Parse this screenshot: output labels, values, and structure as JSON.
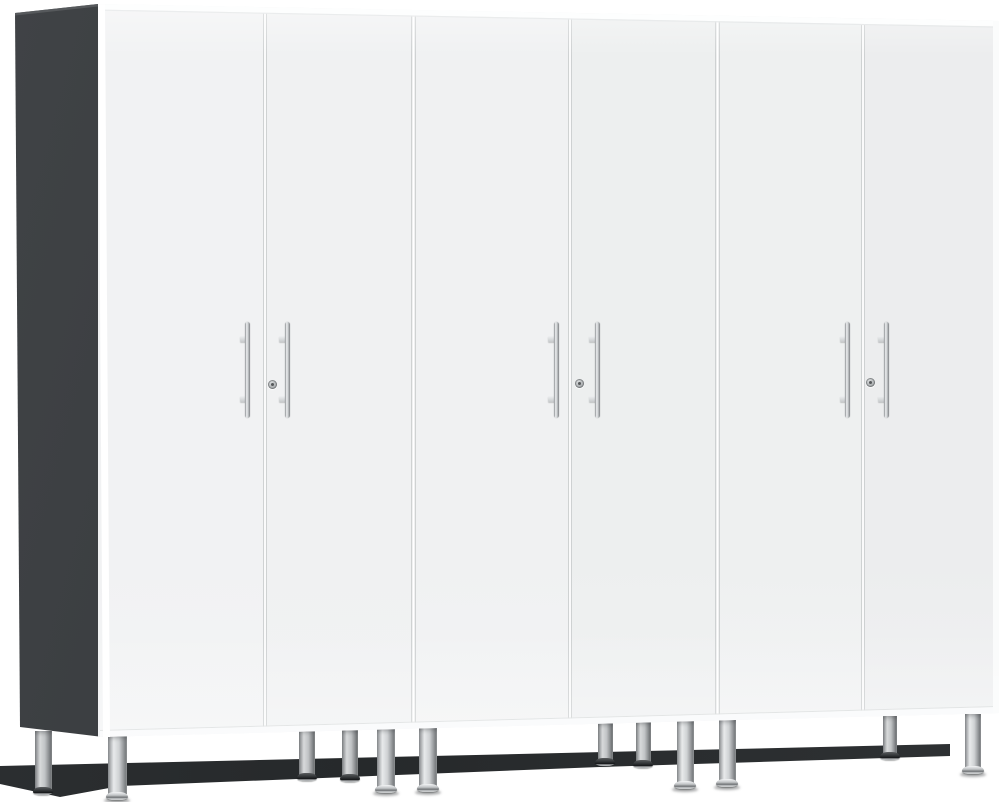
{
  "scene": {
    "width": 1004,
    "height": 802,
    "background": "#ffffff",
    "description": "Product photo: set of three tall white two-door garage storage cabinets with a graphite left side panel, brushed chrome bar handles, center locks, and silver adjustable leveling feet, viewed at a slight left angle on a plain white background"
  },
  "colors": {
    "background": "#ffffff",
    "door_face_light": "#f1f2f3",
    "door_face_dark": "#ecedee",
    "side_panel_dark": "#36393c",
    "side_panel_edge": "#5c5f62",
    "seam_white": "#ffffff",
    "seam_gray": "#c9cccd",
    "handle_chrome_light": "#eef0f1",
    "handle_chrome_dark": "#7f8285",
    "leg_silver_light": "#e8eaeb",
    "leg_silver_dark": "#898c8f",
    "foot_chrome": "#bfc2c4",
    "foot_dark_cone": "#2c2f31",
    "toe_shadow": "#26292b"
  },
  "geometry": {
    "front": {
      "top_left": [
        98,
        4
      ],
      "top_right": [
        999,
        21
      ],
      "bottom_right": [
        999,
        713
      ],
      "bottom_left": [
        100,
        737
      ]
    },
    "side_panel": [
      [
        15,
        13
      ],
      [
        98,
        4
      ],
      [
        103,
        737
      ],
      [
        20,
        727
      ]
    ],
    "side_panel_top_edge": [
      [
        15,
        13
      ],
      [
        98,
        4
      ],
      [
        98,
        6.5
      ],
      [
        15,
        15.5
      ]
    ],
    "toe_shadow_poly": [
      [
        0,
        766
      ],
      [
        950,
        744
      ],
      [
        950,
        756
      ],
      [
        600,
        767
      ],
      [
        120,
        786
      ],
      [
        60,
        797
      ],
      [
        0,
        784
      ]
    ],
    "top_strip_depth": 5.5,
    "bottom_strip_depth": 6
  },
  "cabinets": [
    {
      "name": "cabinet-1",
      "left": 98,
      "right": 413,
      "door_gap_x": 264.5,
      "left_door_color": "#f1f2f3",
      "right_door_color": "#f0f1f2",
      "handle_xs": [
        247.5,
        287
      ],
      "lock": [
        272.5,
        384.5
      ]
    },
    {
      "name": "cabinet-2",
      "left": 413,
      "right": 717,
      "door_gap_x": 570,
      "left_door_color": "#f0f1f2",
      "right_door_color": "#edefef",
      "handle_xs": [
        556,
        597
      ],
      "lock": [
        579.5,
        383
      ]
    },
    {
      "name": "cabinet-3",
      "left": 717,
      "right": 999,
      "door_gap_x": 862.5,
      "left_door_color": "#eef0f0",
      "right_door_color": "#ecedee",
      "handle_xs": [
        847.5,
        886
      ],
      "lock": [
        870.5,
        382
      ]
    }
  ],
  "handle_style": {
    "top": 322,
    "height": 96,
    "width": 5,
    "standoff_tops": [
      336,
      396
    ],
    "standoff_w": 6.5,
    "standoff_h": 5.5
  },
  "lock_style": {
    "diameter": 9
  },
  "legs": [
    {
      "cx": 43,
      "w": 17,
      "top": 731,
      "bottom": 795,
      "row": "back"
    },
    {
      "cx": 117,
      "w": 19,
      "top": 736,
      "bottom": 800,
      "row": "front"
    },
    {
      "cx": 307,
      "w": 16,
      "top": 730,
      "bottom": 781,
      "row": "back"
    },
    {
      "cx": 350,
      "w": 16,
      "top": 730,
      "bottom": 782,
      "row": "back"
    },
    {
      "cx": 386,
      "w": 18,
      "top": 729,
      "bottom": 793,
      "row": "front"
    },
    {
      "cx": 428,
      "w": 18,
      "top": 728,
      "bottom": 792,
      "row": "front"
    },
    {
      "cx": 605,
      "w": 15,
      "top": 723,
      "bottom": 766,
      "row": "back"
    },
    {
      "cx": 643,
      "w": 15,
      "top": 722,
      "bottom": 768,
      "row": "back"
    },
    {
      "cx": 685,
      "w": 17,
      "top": 721,
      "bottom": 789,
      "row": "front"
    },
    {
      "cx": 727,
      "w": 17,
      "top": 720,
      "bottom": 787,
      "row": "front"
    },
    {
      "cx": 890,
      "w": 14,
      "top": 716,
      "bottom": 760,
      "row": "back"
    },
    {
      "cx": 973,
      "w": 16,
      "top": 714,
      "bottom": 774,
      "row": "front"
    }
  ]
}
